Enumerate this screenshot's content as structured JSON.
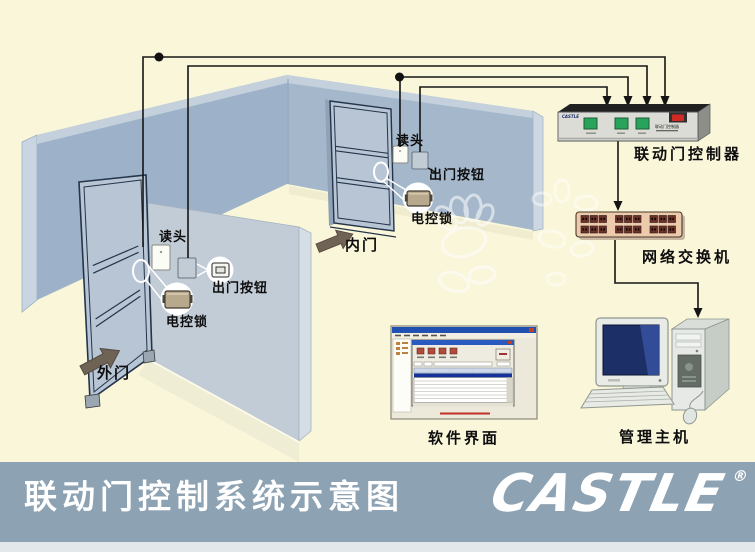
{
  "title_bar": {
    "title": "联动门控制系统示意图",
    "logo_text": "CASTLE",
    "registered_mark": "®"
  },
  "room": {
    "outer_door": {
      "door_label": "外门",
      "reader_label": "读头",
      "exit_button_label": "出门按钮",
      "lock_label": "电控锁"
    },
    "inner_door": {
      "door_label": "内门",
      "reader_label": "读头",
      "exit_button_label": "出门按钮",
      "lock_label": "电控锁"
    }
  },
  "equipment": {
    "controller": {
      "label": "联动门控制器",
      "panel_brand": "CASTLE",
      "panel_text": "联动门控制器"
    },
    "network_switch": {
      "label": "网络交换机"
    },
    "software": {
      "label": "软件界面"
    },
    "host": {
      "label": "管理主机"
    }
  },
  "colors": {
    "background": "#f9f6da",
    "banner": "#8da2b2",
    "wall_blue": "#9db2c8",
    "wall_front": "#c2ccd7",
    "door_panel": "#b7c5d5",
    "button_green": "#27a35c",
    "switch_tan": "#eccaac",
    "screen_blue": "#1c2f66",
    "wire_black": "#151515",
    "title_text": "#ffffff"
  }
}
